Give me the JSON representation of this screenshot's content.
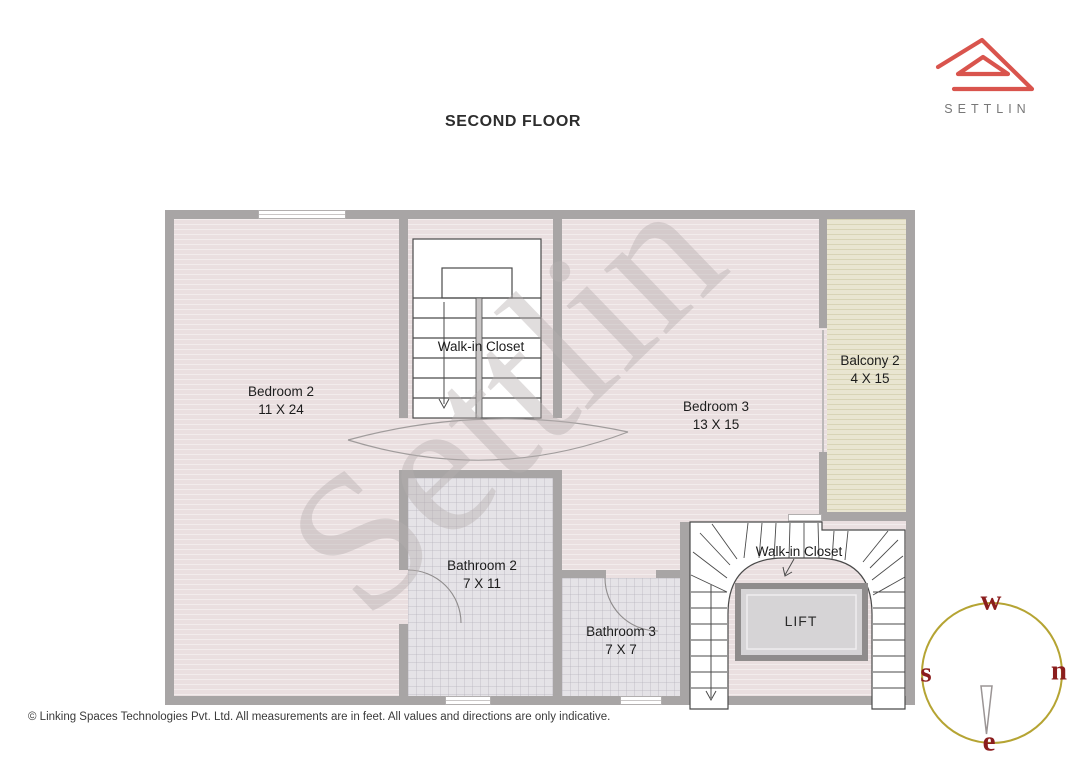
{
  "title": "SECOND FLOOR",
  "logo": {
    "brand": "SETTLIN"
  },
  "watermark": "Settlin",
  "rooms": {
    "bedroom2": {
      "name": "Bedroom 2",
      "dims": "11 X 24"
    },
    "walkin_closet_top": {
      "name": "Walk-in Closet"
    },
    "bedroom3": {
      "name": "Bedroom 3",
      "dims": "13 X 15"
    },
    "balcony2": {
      "name": "Balcony 2",
      "dims": "4 X 15"
    },
    "bathroom2": {
      "name": "Bathroom 2",
      "dims": "7 X 11"
    },
    "bathroom3": {
      "name": "Bathroom 3",
      "dims": "7 X 7"
    },
    "walkin_closet_bottom": {
      "name": "Walk-in Closet"
    },
    "lift": {
      "name": "LIFT"
    }
  },
  "compass": {
    "west": "w",
    "north": "n",
    "south": "s",
    "east": "e"
  },
  "footer": {
    "text": "© Linking Spaces Technologies Pvt. Ltd. All measurements are in feet. All values and directions are only indicative."
  },
  "palette": {
    "logo_red": "#d9544d",
    "wall_gray": "#a8a5a5",
    "floor_pink": "#eadfe0",
    "balcony_beige": "#e9e5d1",
    "tile_gray": "#e5e3e7",
    "compass_circle_gold": "#b5a433",
    "compass_letter_red": "#8b1d1d",
    "label_ink": "#1c1c1c"
  }
}
